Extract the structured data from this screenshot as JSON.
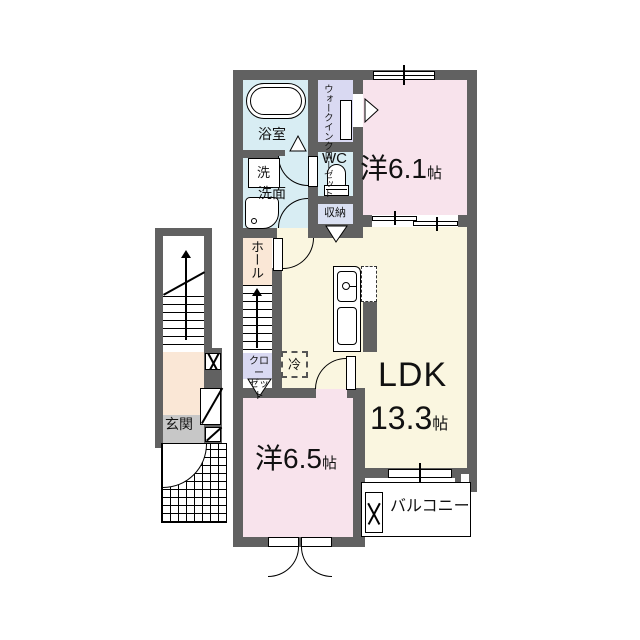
{
  "labels": {
    "bathroom": "浴室",
    "washer": "洗",
    "washroom": "洗面",
    "wc": "WC",
    "walk_in_closet": "ウォークインクローゼット",
    "storage": "収納",
    "room1_name": "洋6.1",
    "room1_unit": "帖",
    "hall": "ホール",
    "closet_line1": "クロー",
    "closet_line2": "ゼット",
    "fridge": "冷",
    "ldk_name": "LDK",
    "ldk_size": "13.3",
    "ldk_unit": "帖",
    "room2_name": "洋6.5",
    "room2_unit": "帖",
    "entrance": "玄関",
    "balcony": "バルコニー"
  },
  "colors": {
    "wall": "#616161",
    "pink": "#F8E3EC",
    "cream": "#FAF6E0",
    "peach": "#FAE7D6",
    "aqua": "#D8EDF3",
    "lavender": "#D9D9F2",
    "storagebg": "#DAE0F2",
    "genkan": "#C7C7C7"
  }
}
